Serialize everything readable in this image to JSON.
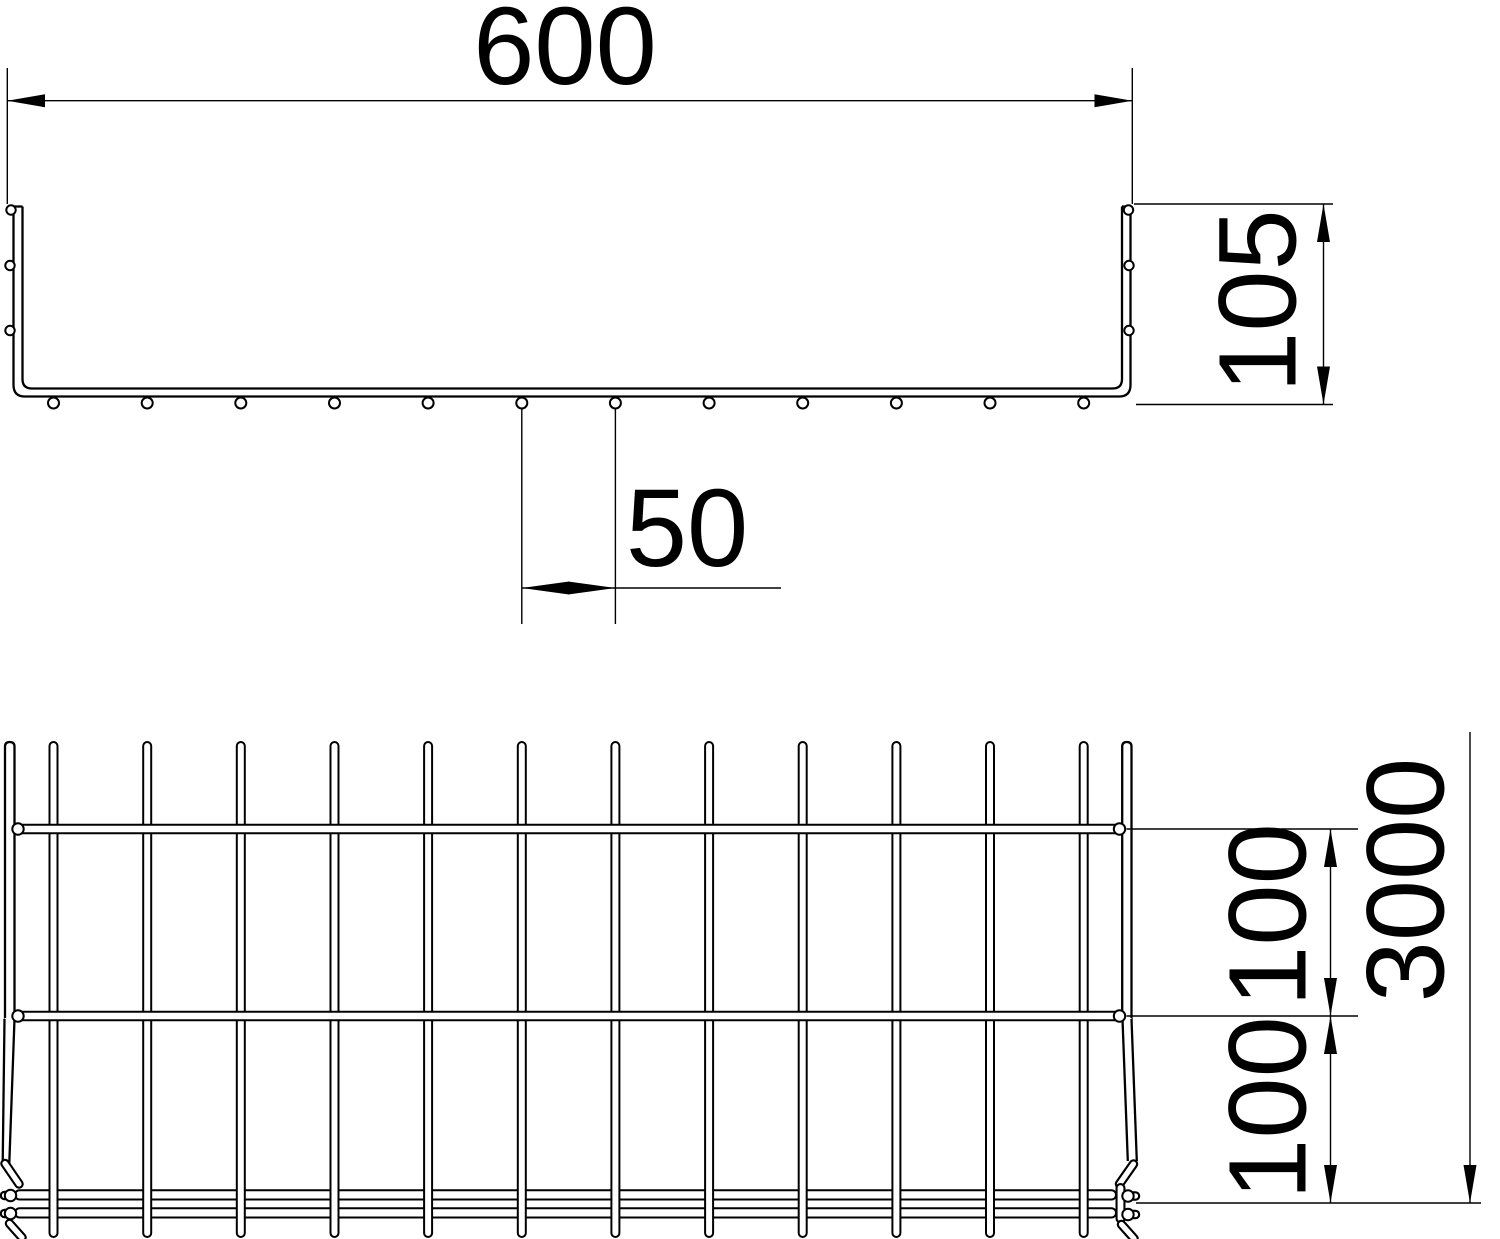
{
  "meta": {
    "background_color": "#ffffff",
    "line_color": "#000000",
    "drawing_type": "mesh cable tray technical drawing"
  },
  "dims": {
    "width": "600",
    "height": "105",
    "wire_spacing": "50",
    "pitch_upper": "100",
    "pitch_lower": "100",
    "length": "3000"
  },
  "drawing_data": {
    "longitudinal_wire_xs": [
      53.5,
      147.2,
      240.8,
      334.5,
      428.1,
      521.8,
      615.4,
      709.1,
      802.7,
      896.4,
      990.0,
      1083.7
    ],
    "bottom_circle_y": 403,
    "bottom_circle_r": 5.5,
    "rim_circle_y": 210,
    "rim_circle_xs": [
      11,
      1128.5
    ],
    "wall_side_circle_ys": [
      265.5,
      330.5
    ],
    "wall_side_circle_xs": [
      10,
      1129
    ],
    "plan_wire_top_y": 742,
    "plan_wire_bottom_y": 1237,
    "plan_wire_width": 8,
    "plan_cross_wire_ys": [
      829,
      1016
    ],
    "plan_cross_wire_x1": 16,
    "plan_cross_wire_x2": 1120,
    "plan_weld_circle_xs": [
      18,
      1119.5
    ],
    "plan_rail_ys": [
      1190.2,
      1208.2
    ],
    "plan_rail_x": 15,
    "plan_rail_w": 1101,
    "plan_rail_h": 9.3
  }
}
